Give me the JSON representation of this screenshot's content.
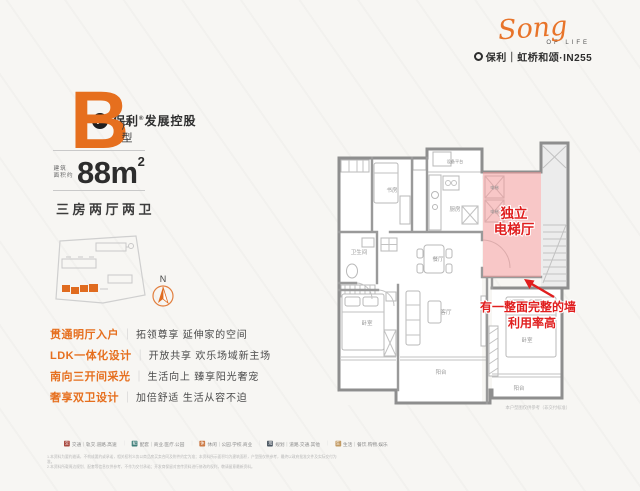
{
  "colors": {
    "accent_orange": "#E66F1E",
    "annotation_red": "#E01E1E",
    "highlight_pink": "#F29999",
    "wall_gray": "#8E8E8E"
  },
  "header": {
    "developer": {
      "mark_glyph": "P",
      "name_part1": "保利",
      "reg_mark": "®",
      "name_part2": "发展控股"
    },
    "brand": {
      "script": "Song",
      "script_sub": "OF LIFE",
      "line": "保利｜虹桥和颂·IN255"
    }
  },
  "unit_card": {
    "type_letter": "B",
    "type_label": "户型",
    "area_prefix_line1": "建筑",
    "area_prefix_line2": "面积约",
    "area_value": "88m",
    "area_superscript": "2",
    "layout_text": "三房两厅两卫",
    "compass_label": "N"
  },
  "features": [
    {
      "title": "贯通明厅入户",
      "separator": "｜",
      "desc": "拓领尊享 延伸家的空间"
    },
    {
      "title": "LDK一体化设计",
      "separator": "｜",
      "desc": "开放共享 欢乐场域新主场"
    },
    {
      "title": "南向三开间采光",
      "separator": "｜",
      "desc": "生活向上 臻享阳光奢宠"
    },
    {
      "title": "奢享双卫设计",
      "separator": "｜",
      "desc": "加倍舒适 生活从容不迫"
    }
  ],
  "floorplan": {
    "room_labels": {
      "study": "书房",
      "equipment_platform": "设备平台",
      "kitchen": "厨房",
      "bathroom": "卫生间",
      "dining": "餐厅",
      "living": "客厅",
      "balcony_center": "阳台",
      "bedroom_left": "卧室",
      "bedroom_right": "卧室",
      "balcony_right": "阳台",
      "elevator_top": "电梯",
      "elevator_bottom": "电梯"
    },
    "annotations": {
      "elevator_hall_line1": "独立",
      "elevator_hall_line2": "电梯厅",
      "wall_note_line1": "有一整面完整的墙",
      "wall_note_line2": "利用率高"
    },
    "caption": "本户型图仅供参考（非交付标准）"
  },
  "legend": {
    "items": [
      {
        "glyph": "交",
        "color": "#A8493F",
        "label": "交通｜轨交.道路.高速"
      },
      {
        "glyph": "配",
        "color": "#3F7D78",
        "label": "配套｜商业.医疗.公园"
      },
      {
        "glyph": "休",
        "color": "#CC7A45",
        "label": "休闲｜公园.学校.商业"
      },
      {
        "glyph": "规",
        "color": "#4A5560",
        "label": "规划｜道路.交通.其他"
      },
      {
        "glyph": "生",
        "color": "#C29A62",
        "label": "生活｜餐饮.购物.娱乐"
      }
    ],
    "disclaimer_line1": "1.本资料为要约邀请，不构成要约或承诺，相关权利义务以商品房买卖合同及附件约定为准；本资料所示面积均为建筑面积，户型图仅供参考，最终以政府批准文件及实际交付为准。",
    "disclaimer_line2": "2.本资料所载周边规划、配套等信息仅供参考，不作为交付承诺；开发商保留对宣传资料进行修改的权利，敬请留意最新资料。"
  }
}
